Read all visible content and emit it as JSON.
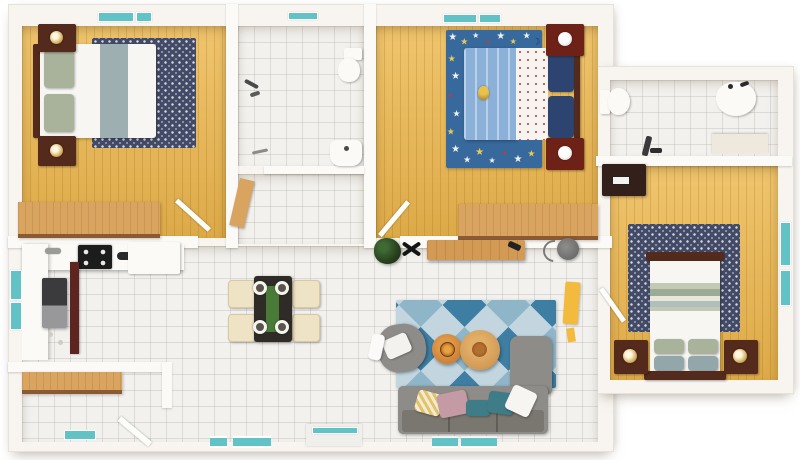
{
  "scene_type": "3d-floor-plan-render",
  "palette": {
    "bg": "#ffffff",
    "wall": "#f8f5f1",
    "wall_face": "#fcfaf7",
    "wall_edge": "#e6e1d9",
    "wood": "#edba52",
    "desk_wood": "#d9a45f",
    "tile": "#f2f1ee",
    "teal": "#62c3c6",
    "navy_rug": "#414a68",
    "rug_dot": "#ddd8d0",
    "kids_rug": "#38699c",
    "kids_bed": "#8cb1d8",
    "kids_pillow": "#2e4470",
    "bed_white": "#f7f6f2",
    "sage": "#a9b39c",
    "blue_gray": "#93a7ab",
    "dark_wood": "#532a1b",
    "red_wood": "#6e2217",
    "lamp_gold": "#c9a24a",
    "sofa": "#8d8c88",
    "sofa_dark": "#79776f",
    "rug_light": "#c3d6e0",
    "rug_mid": "#8fb6c8",
    "rug_dark": "#3e7ea2",
    "orange_table": "#c97f35",
    "tan_table": "#d29a55",
    "plant": "#27401e",
    "black": "#1c1c1c",
    "fridge": "#3b3b3d",
    "maroon": "#5e2420",
    "cream": "#efe3c6",
    "pink": "#c49aa4",
    "teal_pillow": "#3e7d88",
    "yellow": "#e0c36a",
    "drape": "#f2bb3e",
    "table_dark": "#2f2b26",
    "runner_green": "#4a7a38"
  },
  "icons": {
    "star": "★",
    "dot": "●",
    "moon": "☽"
  },
  "rooms": {
    "master_bedroom": {
      "label": "master-bedroom",
      "furniture": [
        "double-bed",
        "sage-pillows",
        "patterned-rug",
        "nightstand-with-lamp",
        "nightstand-with-lamp",
        "dresser-desk",
        "window",
        "door"
      ]
    },
    "bathroom": {
      "label": "bathroom",
      "furniture": [
        "toilet",
        "shower-fixture",
        "sink",
        "window"
      ]
    },
    "hallway": {
      "label": "hallway",
      "furniture": [
        "open-wood-door"
      ]
    },
    "kids_bedroom": {
      "label": "kids-bedroom",
      "furniture": [
        "single-bed",
        "star-rug",
        "teddy-bear",
        "nightstand-with-lamp",
        "nightstand-with-lamp",
        "desk",
        "windows",
        "door"
      ]
    },
    "kitchen": {
      "label": "kitchen",
      "furniture": [
        "l-shaped-counter",
        "cooktop",
        "sink-faucet",
        "refrigerator",
        "dishwasher",
        "pantry-cabinet",
        "window"
      ]
    },
    "laundry_room": {
      "label": "laundry-room",
      "furniture": [
        "wood-shelf",
        "door",
        "floor-mat"
      ]
    },
    "dining_area": {
      "label": "dining-area",
      "furniture": [
        "dining-table",
        "four-chairs",
        "place-settings",
        "green-runner",
        "potted-plant"
      ]
    },
    "living_room": {
      "label": "living-room",
      "furniture": [
        "sectional-sofa",
        "throw-pillows",
        "coffee-table",
        "coffee-table",
        "armchair",
        "diamond-rug",
        "tv-console",
        "floor-lamp",
        "yellow-drape",
        "patio-door",
        "windows"
      ]
    },
    "second_bathroom": {
      "label": "second-bathroom",
      "furniture": [
        "toilet",
        "sink",
        "vanity-counter",
        "fixture"
      ]
    },
    "second_bedroom": {
      "label": "second-bedroom",
      "furniture": [
        "double-bed",
        "patterned-rug",
        "nightstand-with-lamp",
        "nightstand-with-lamp",
        "dresser",
        "window",
        "door"
      ]
    }
  },
  "kids_rug_stars": [
    {
      "x": 7,
      "y": 6,
      "c": "#eef2f6",
      "s": 10,
      "g": "star"
    },
    {
      "x": 19,
      "y": 9,
      "c": "#e8cc52",
      "s": 9,
      "g": "star"
    },
    {
      "x": 31,
      "y": 4,
      "c": "#eef2f6",
      "s": 8,
      "g": "star"
    },
    {
      "x": 44,
      "y": 9,
      "c": "#c23c32",
      "s": 7,
      "g": "dot"
    },
    {
      "x": 57,
      "y": 5,
      "c": "#eef2f6",
      "s": 10,
      "g": "star"
    },
    {
      "x": 70,
      "y": 9,
      "c": "#e8cc52",
      "s": 8,
      "g": "star"
    },
    {
      "x": 84,
      "y": 4,
      "c": "#eef2f6",
      "s": 9,
      "g": "star"
    },
    {
      "x": 94,
      "y": 9,
      "c": "#1e3a66",
      "s": 9,
      "g": "moon"
    },
    {
      "x": 6,
      "y": 21,
      "c": "#e8cc52",
      "s": 9,
      "g": "star"
    },
    {
      "x": 10,
      "y": 34,
      "c": "#eef2f6",
      "s": 10,
      "g": "star"
    },
    {
      "x": 5,
      "y": 48,
      "c": "#c23c32",
      "s": 7,
      "g": "dot"
    },
    {
      "x": 11,
      "y": 61,
      "c": "#eef2f6",
      "s": 9,
      "g": "star"
    },
    {
      "x": 5,
      "y": 74,
      "c": "#e8cc52",
      "s": 9,
      "g": "star"
    },
    {
      "x": 10,
      "y": 87,
      "c": "#eef2f6",
      "s": 10,
      "g": "star"
    },
    {
      "x": 22,
      "y": 94,
      "c": "#eef2f6",
      "s": 9,
      "g": "star"
    },
    {
      "x": 35,
      "y": 89,
      "c": "#e8cc52",
      "s": 10,
      "g": "star"
    },
    {
      "x": 48,
      "y": 95,
      "c": "#eef2f6",
      "s": 8,
      "g": "star"
    },
    {
      "x": 61,
      "y": 89,
      "c": "#c23c32",
      "s": 7,
      "g": "dot"
    },
    {
      "x": 75,
      "y": 94,
      "c": "#eef2f6",
      "s": 10,
      "g": "star"
    },
    {
      "x": 89,
      "y": 90,
      "c": "#e8cc52",
      "s": 9,
      "g": "star"
    }
  ]
}
